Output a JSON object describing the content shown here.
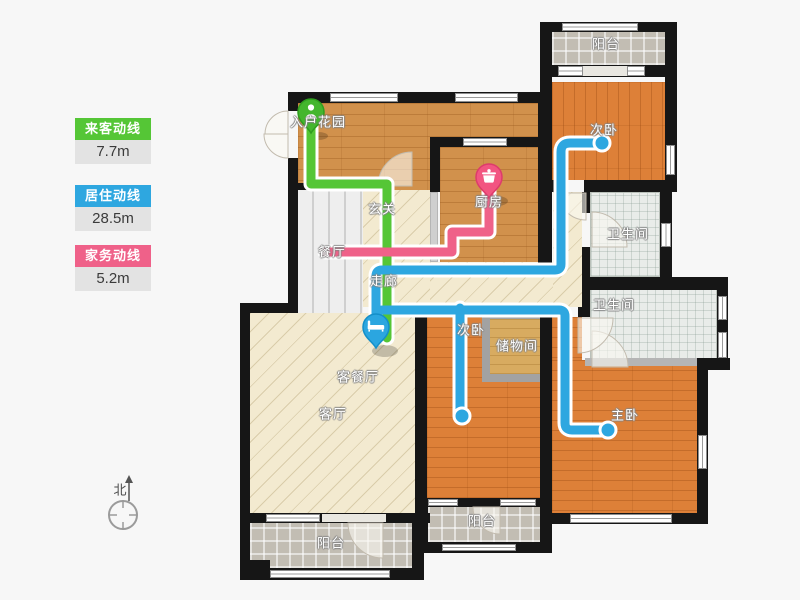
{
  "legend": {
    "items": [
      {
        "id": "guest",
        "label": "来客动线",
        "value": "7.7m",
        "color": "#55c636"
      },
      {
        "id": "living",
        "label": "居住动线",
        "value": "28.5m",
        "color": "#2ea7e0"
      },
      {
        "id": "chores",
        "label": "家务动线",
        "value": "5.2m",
        "color": "#ef6189"
      }
    ]
  },
  "compass": {
    "label": "北"
  },
  "rooms": {
    "entry_garden": "入户花园",
    "foyer": "玄关",
    "dining": "餐厅",
    "kitchen": "厨房",
    "corridor": "走廊",
    "living_dining": "客餐厅",
    "living": "客厅",
    "bedroom_top": "次卧",
    "bedroom_mid": "次卧",
    "master": "主卧",
    "storage": "储物间",
    "bath_top": "卫生间",
    "bath_bottom": "卫生间",
    "balcony_top": "阳台",
    "balcony_mid": "阳台",
    "balcony_left": "阳台"
  },
  "icons": {
    "guest_pin": "person-icon",
    "living_pin": "bed-icon",
    "chores_pin": "pot-icon"
  }
}
